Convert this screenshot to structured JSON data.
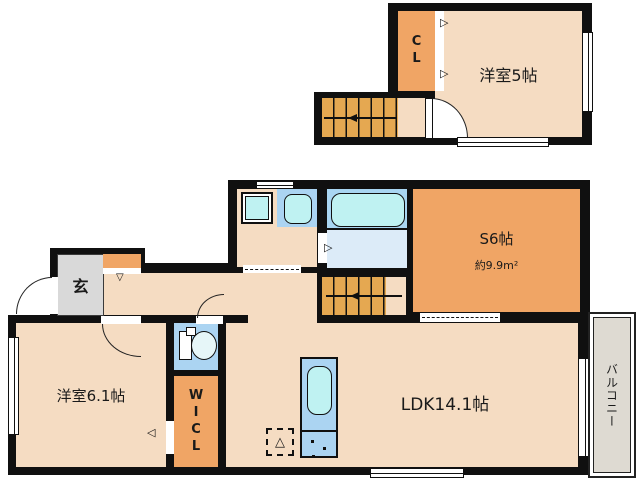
{
  "colors": {
    "wall": "#101010",
    "room": "#f5dcc2",
    "closet": "#f0a565",
    "stairs": "#e5a851",
    "genkan": "#d9d9d9",
    "water": "#abd4f2",
    "tub_zone": "#a9d6f2",
    "bath_floor": "#dcebf8",
    "fixture_cyan": "#bff2f2",
    "balcony": "#dedad2"
  },
  "floor2": {
    "closet": {
      "label": "CL"
    },
    "bedroom": {
      "label": "洋室5帖"
    }
  },
  "floor1": {
    "service_room": {
      "label": "S6帖",
      "area": "約9.9m²"
    },
    "entrance": {
      "label": "玄"
    },
    "bedroom": {
      "label": "洋室6.1帖"
    },
    "walk_in_closet": {
      "label": "WICL"
    },
    "ldk": {
      "label": "LDK14.1帖"
    },
    "balcony": {
      "label": "バルコニー"
    }
  },
  "glyphs": {
    "door_right": "▷",
    "door_down": "▽",
    "door_left": "◁",
    "fridge_triangle": "△"
  }
}
